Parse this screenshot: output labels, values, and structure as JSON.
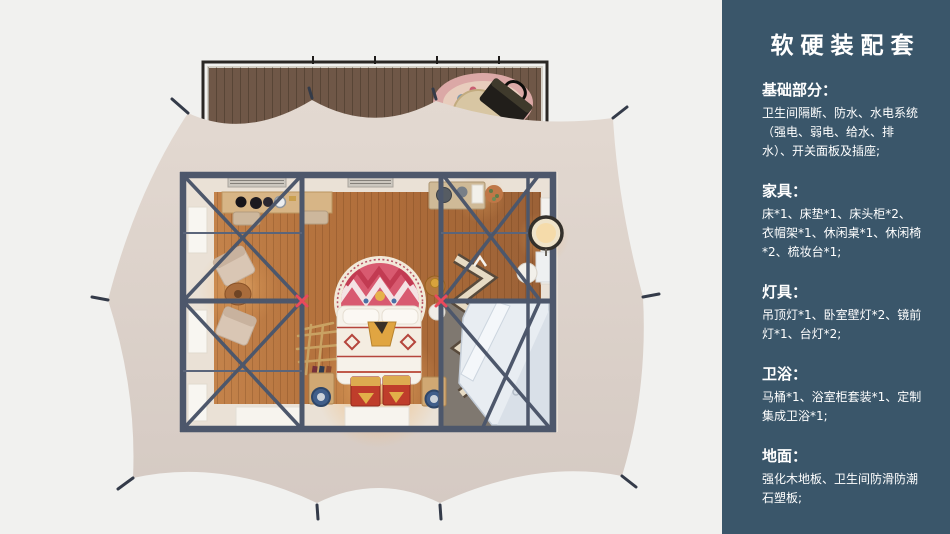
{
  "sidebar": {
    "title": "软硬装配套",
    "sections": [
      {
        "heading": "基础部分：",
        "body": "卫生间隔断、防水、水电系统（强电、弱电、给水、排水）、开关面板及插座;"
      },
      {
        "heading": "家具：",
        "body": "床*1、床垫*1、床头柜*2、衣帽架*1、休闲桌*1、休闲椅*2、梳妆台*1;"
      },
      {
        "heading": "灯具：",
        "body": "吊顶灯*1、卧室壁灯*2、镜前灯*1、台灯*2;"
      },
      {
        "heading": "卫浴：",
        "body": "马桶*1、浴室柜套装*1、定制集成卫浴*1;"
      },
      {
        "heading": "地面：",
        "body": "强化木地板、卫生间防滑防潮石塑板;"
      }
    ]
  },
  "palette": {
    "page_bg": "#f1f1ef",
    "sidebar_bg": "#3a566a",
    "sidebar_text": "#ffffff",
    "tent_fabric": "#dbd0c8",
    "deck_wood": "#6f5747",
    "frame_beam": "#4d576b",
    "joint_accent": "#ea4a5c",
    "floor_wood": "#b0703c",
    "bathroom_floor": "#7f7870",
    "shower_white": "#e8edf2",
    "mandala_pink": "#d85a70",
    "chest_red": "#bf3d2b",
    "gold": "#ddab50",
    "wall_cream": "#eae1d6"
  }
}
